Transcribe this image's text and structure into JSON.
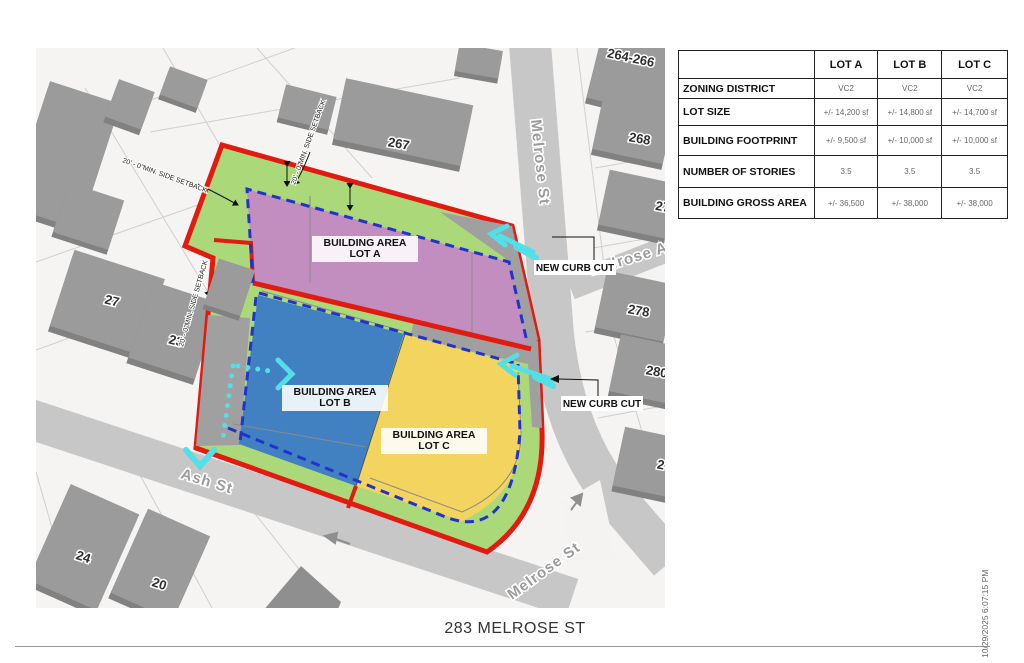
{
  "page": {
    "title": "283 MELROSE ST",
    "timestamp": "10/29/2025 6:07:15 PM"
  },
  "table": {
    "corner": "",
    "columns": [
      "LOT A",
      "LOT B",
      "LOT C"
    ],
    "rows": [
      {
        "label": "ZONING DISTRICT",
        "values": [
          "VC2",
          "VC2",
          "VC2"
        ]
      },
      {
        "label": "LOT SIZE",
        "values": [
          "+/- 14,200 sf",
          "+/- 14,800 sf",
          "+/- 14,700 sf"
        ]
      },
      {
        "label": "BUILDING FOOTPRINT",
        "values": [
          "+/- 9,500 sf",
          "+/- 10,000 sf",
          "+/- 10,000 sf"
        ]
      },
      {
        "label": "NUMBER OF STORIES",
        "values": [
          "3.5",
          "3.5",
          "3.5"
        ]
      },
      {
        "label": "BUILDING GROSS AREA",
        "values": [
          "+/- 36,500",
          "+/- 38,000",
          "+/- 38,000"
        ]
      }
    ]
  },
  "map": {
    "streets": {
      "melrose_st": "Melrose St",
      "melrose_ave": "Melrose Ave",
      "ash_st": "Ash St",
      "melrose_st_south": "Melrose St"
    },
    "lots": {
      "line1": "BUILDING AREA",
      "a": "LOT A",
      "b": "LOT B",
      "c": "LOT C"
    },
    "annotations": {
      "setback": "20' - 0\"MIN. SIDE SETBACK",
      "new_curb_cut": "NEW CURB CUT"
    },
    "parcels": {
      "p264": "264-266",
      "p267": "267",
      "p268": "268",
      "p270": "27",
      "p278": "278",
      "p280": "280",
      "p282": "2",
      "p27": "27",
      "p23": "23",
      "p24": "24",
      "p20": "20"
    },
    "colors": {
      "site_boundary": "#e11b12",
      "build_to_line": "#2233cc",
      "lot_a": "#c18ebf",
      "lot_b": "#4181c1",
      "lot_c": "#f3d45f",
      "setback_green": "#abd878",
      "circulation": "#52dfe8",
      "driveway_gray": "#a0a0a0"
    }
  }
}
